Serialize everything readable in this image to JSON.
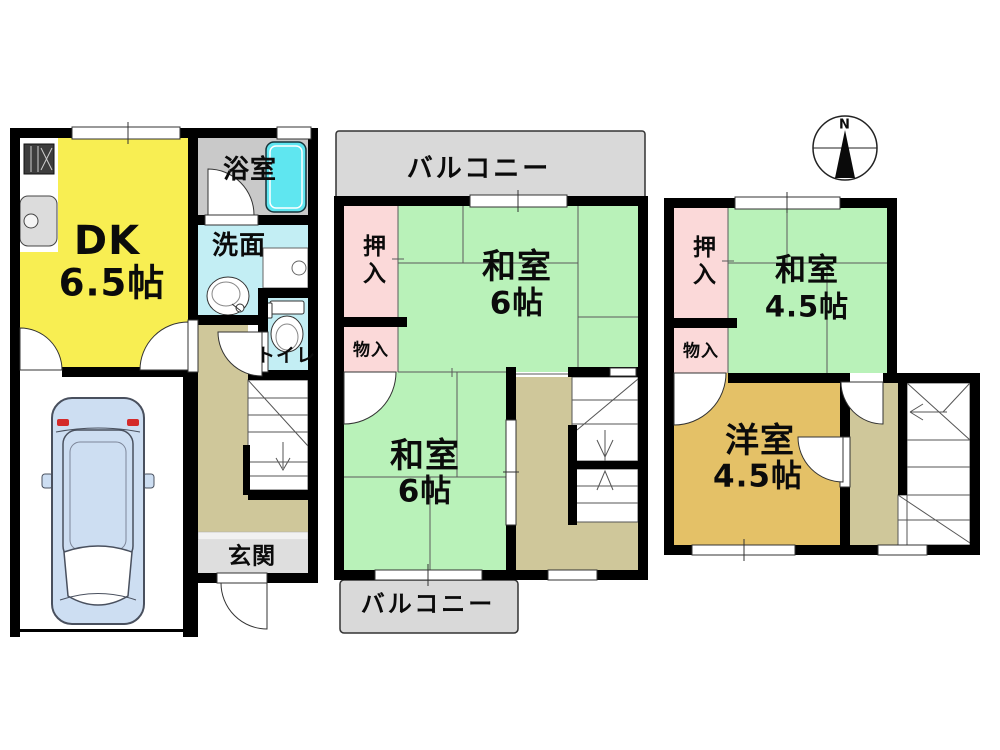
{
  "floorplan": {
    "compass": {
      "label": "N"
    },
    "floor1": {
      "dk": {
        "name": "DK",
        "size": "6.5帖"
      },
      "bathroom": {
        "label": "浴室"
      },
      "washroom": {
        "label": "洗面"
      },
      "toilet": {
        "label": "トイレ"
      },
      "entrance": {
        "label": "玄関"
      }
    },
    "floor2": {
      "balcony_top": {
        "label": "バルコニー"
      },
      "balcony_bottom": {
        "label": "バルコニー"
      },
      "oshiire": {
        "label": "押入"
      },
      "monoire": {
        "label": "物入"
      },
      "washitsu_upper": {
        "name": "和室",
        "size": "6帖"
      },
      "washitsu_lower": {
        "name": "和室",
        "size": "6帖"
      }
    },
    "floor3": {
      "oshiire": {
        "label": "押入"
      },
      "monoire": {
        "label": "物入"
      },
      "washitsu": {
        "name": "和室",
        "size": "4.5帖"
      },
      "youshitsu": {
        "name": "洋室",
        "size": "4.5帖"
      }
    },
    "colors": {
      "dk_yellow": "#f8ee52",
      "tatami_green": "#b9f2b9",
      "closet_pink": "#fbd9d9",
      "western_tan": "#e4c167",
      "hallway_beige": "#cfc79a",
      "balcony_gray": "#d9d9d9",
      "entrance_gray": "#dedede",
      "bath_gray": "#c9c9c9",
      "wet_cyan": "#c3eef4",
      "bathtub_cyan": "#5fe6f0",
      "car_blue": "#cddef2",
      "wall_black": "#000000"
    }
  }
}
